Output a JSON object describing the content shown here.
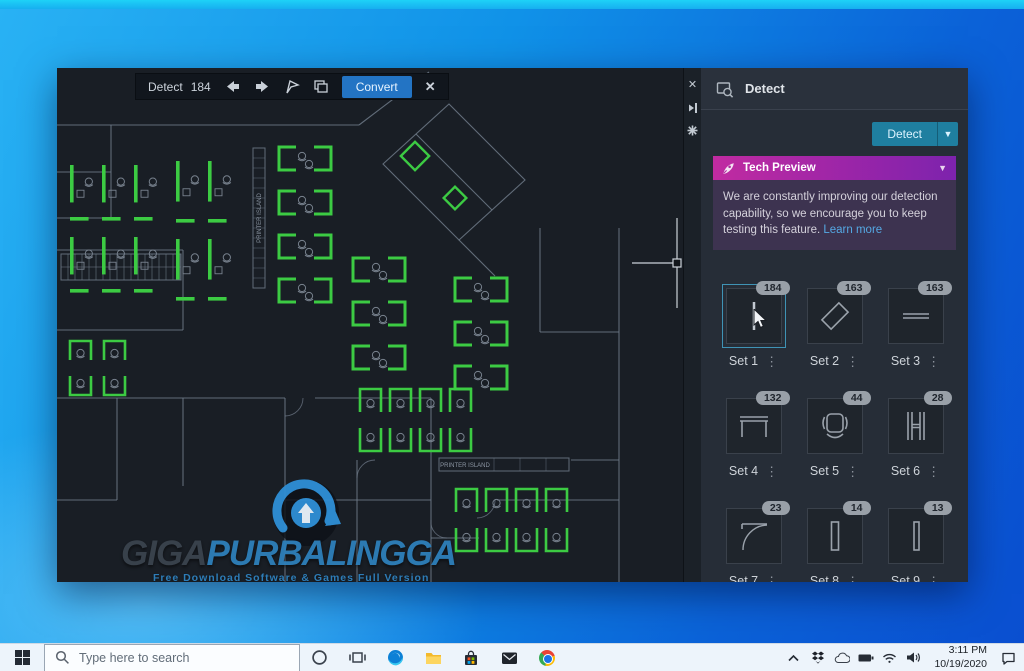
{
  "window": {
    "toolbar": {
      "label": "Detect",
      "count": "184",
      "convert_label": "Convert",
      "icons": [
        "prev-arrow",
        "next-arrow",
        "flag",
        "copy-sets",
        "close"
      ]
    },
    "panel": {
      "title": "Detect",
      "detect_button_label": "Detect",
      "strip_icons": [
        "close",
        "auto-hide",
        "properties"
      ],
      "tech_preview": {
        "title": "Tech Preview",
        "body": "We are constantly improving our detection capability, so we encourage you to keep testing this feature. ",
        "link": "Learn more"
      },
      "sets": [
        {
          "label": "Set 1",
          "count": "184",
          "glyph": "vline",
          "selected": true
        },
        {
          "label": "Set 2",
          "count": "163",
          "glyph": "diamond",
          "selected": false
        },
        {
          "label": "Set 3",
          "count": "163",
          "glyph": "hlines",
          "selected": false
        },
        {
          "label": "Set 4",
          "count": "132",
          "glyph": "desk",
          "selected": false
        },
        {
          "label": "Set 5",
          "count": "44",
          "glyph": "chair",
          "selected": false
        },
        {
          "label": "Set 6",
          "count": "28",
          "glyph": "hbeam",
          "selected": false
        },
        {
          "label": "Set 7",
          "count": "23",
          "glyph": "door",
          "selected": false
        },
        {
          "label": "Set 8",
          "count": "14",
          "glyph": "vrect",
          "selected": false
        },
        {
          "label": "Set 9",
          "count": "13",
          "glyph": "vrect2",
          "selected": false
        }
      ]
    },
    "watermark": {
      "giga": "GIGA",
      "rest": "PURBALINGGA",
      "tagline": "Free Download Software & Games Full Version"
    },
    "drawing": {
      "printer_island_label": "PRINTER ISLAND",
      "colors": {
        "bg": "#191e25",
        "wall": "#6f7a88",
        "green": "#3ccb43",
        "chair": "#78828e",
        "cross": "#ccd2d9"
      },
      "walls": [
        "M0,57 H302",
        "M302,57 L372,4",
        "M0,104 H54",
        "M54,57 V150",
        "M0,150 H54",
        "M326,96 L392,36 L468,112 L402,172 Z",
        "M359,66 L435,142",
        "M402,172 L438,208",
        "M483,160 V264",
        "M483,264 H562",
        "M562,160 V392",
        "M0,182 H126",
        "M126,182 V262",
        "M0,262 H126",
        "M0,330 H228",
        "M258,330 H374",
        "M60,330 V432",
        "M126,330 V418",
        "M228,330 V514",
        "M300,392 V514",
        "M228,432 H374",
        "M374,330 V514",
        "M374,470 H422",
        "M440,432 H562",
        "M514,392 H562",
        "M0,432 H60",
        "M562,392 V514"
      ],
      "arcs": [
        "M246,330 A18,18 0 0 1 228,348",
        "M318,392 A18,18 0 0 0 300,410",
        "M438,432 A18,18 0 0 1 420,450",
        "M374,452 A16,16 0 0 0 390,470"
      ],
      "clusters": [
        {
          "style": "bars",
          "x": 12,
          "y": 92,
          "cols": 3,
          "rows": 2,
          "cw": 32,
          "ch": 72
        },
        {
          "style": "bars",
          "x": 118,
          "y": 88,
          "cols": 2,
          "rows": 2,
          "cw": 32,
          "ch": 78
        },
        {
          "style": "spine",
          "x": 222,
          "y": 74,
          "rows": 4,
          "ch": 44
        },
        {
          "style": "spine",
          "x": 296,
          "y": 185,
          "rows": 3,
          "ch": 44
        },
        {
          "style": "spine",
          "x": 398,
          "y": 205,
          "rows": 3,
          "ch": 44
        },
        {
          "style": "grid",
          "x": 300,
          "y": 318,
          "cols": 4,
          "rows": 2,
          "cw": 30,
          "ch": 34
        },
        {
          "style": "grid",
          "x": 396,
          "y": 418,
          "cols": 4,
          "rows": 2,
          "cw": 30,
          "ch": 34
        },
        {
          "style": "grid",
          "x": 10,
          "y": 270,
          "cols": 2,
          "rows": 2,
          "cw": 34,
          "ch": 30
        }
      ],
      "diamonds": [
        {
          "cx": 358,
          "cy": 88,
          "s": 20
        },
        {
          "cx": 398,
          "cy": 130,
          "s": 16
        }
      ],
      "stairs": {
        "x": 4,
        "y": 186,
        "w": 120,
        "h": 26,
        "step": 7
      },
      "printer_vertical": {
        "x": 196,
        "y": 80,
        "w": 12,
        "h": 140
      },
      "printer_horizontal": {
        "x": 382,
        "y": 390,
        "w": 130,
        "h": 13
      },
      "crosshair": {
        "x": 620,
        "y": 195,
        "arm": 45,
        "box": 8
      }
    }
  },
  "taskbar": {
    "search_placeholder": "Type here to search",
    "icons": [
      "start",
      "cortana",
      "task-view",
      "edge",
      "file-explorer",
      "store",
      "mail",
      "chrome"
    ],
    "tray": {
      "icons": [
        "hidden-icons-chevron",
        "dropbox",
        "onedrive",
        "battery",
        "wifi",
        "volume"
      ],
      "time": "3:11 PM",
      "date": "10/19/2020",
      "action_center": "action-center"
    }
  }
}
